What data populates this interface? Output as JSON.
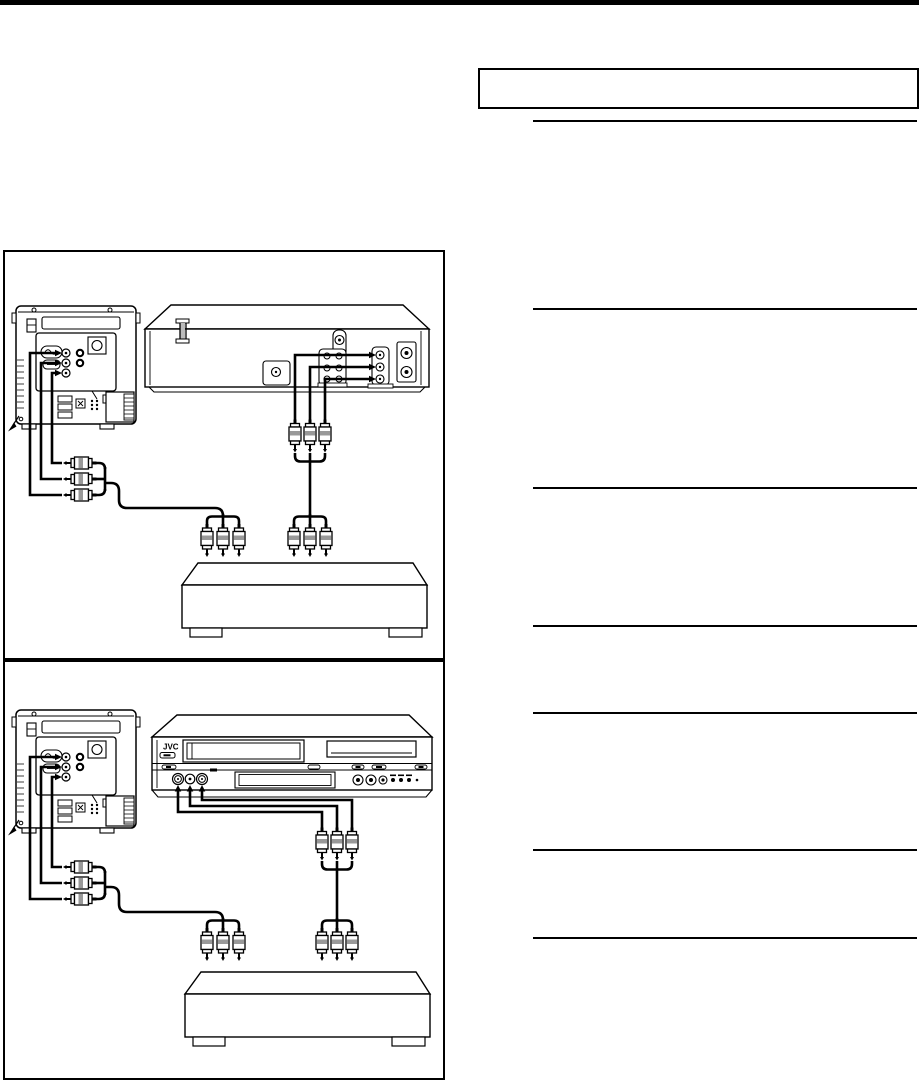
{
  "page": {
    "background": "#ffffff",
    "top_bar_color": "#000000",
    "ink_color": "#000000",
    "plug_band_color": "#999999"
  },
  "right_column": {
    "callout_box": {
      "visible_text": ""
    },
    "horizontal_rule_count": 7
  },
  "diagram_top": {
    "name": "tv-vcr-receiver-connection",
    "devices": {
      "tv": "tv-rear-panel",
      "vcr": "vcr-rear-panel",
      "receiver": "audio-receiver"
    },
    "cables": "rca-audio-video-cables"
  },
  "diagram_bottom": {
    "name": "tv-dvd-vcr-receiver-connection",
    "jvc_logo": "JVC",
    "devices": {
      "tv": "tv-rear-panel",
      "dvd_vcr": "jvc-dvd-vcr-front-panel",
      "receiver": "audio-receiver"
    },
    "cables": "rca-audio-video-cables"
  }
}
